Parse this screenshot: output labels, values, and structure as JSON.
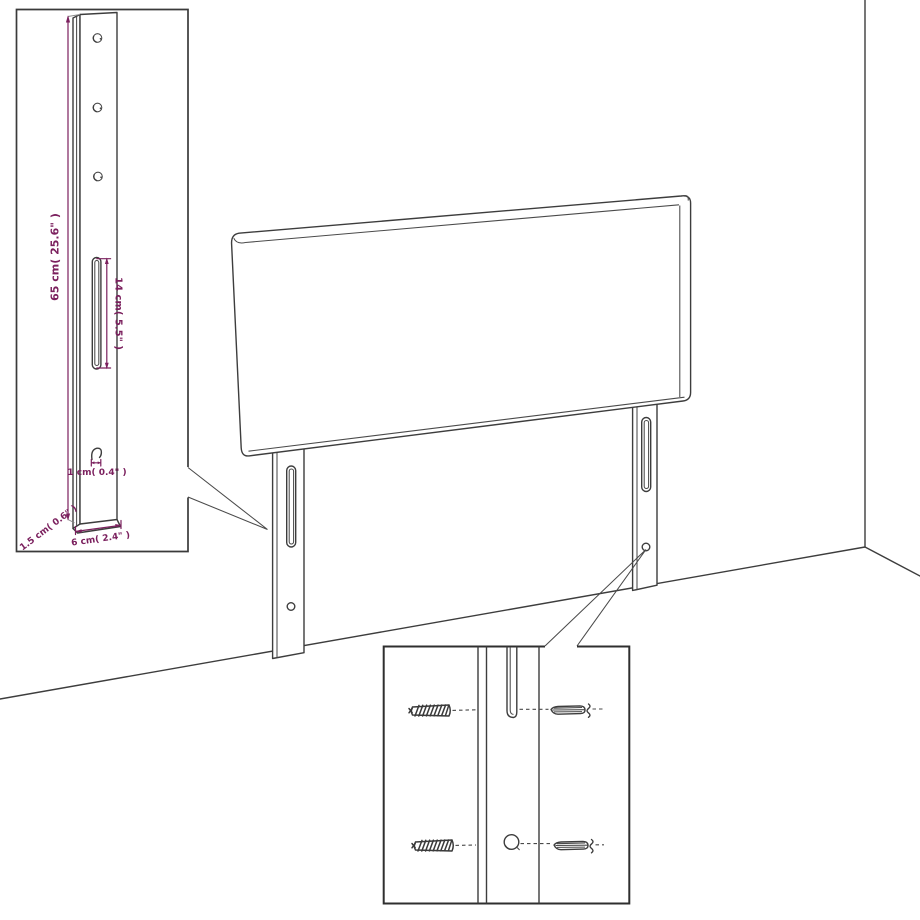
{
  "diagram_type": "headboard wall-mounting assembly diagram",
  "colors": {
    "outline": "#3d3d3d",
    "dimension_text": "#7b205e",
    "background": "#ffffff"
  },
  "leg_detail_inset": {
    "dimensions": {
      "height": "65 cm( 25.6\" )",
      "slot_length": "14 cm( 5.5\" )",
      "hook_depth": "1 cm( 0.4\" )",
      "thickness": "1.5 cm( 0.6\" )",
      "width": "6 cm( 2.4\" )"
    }
  }
}
